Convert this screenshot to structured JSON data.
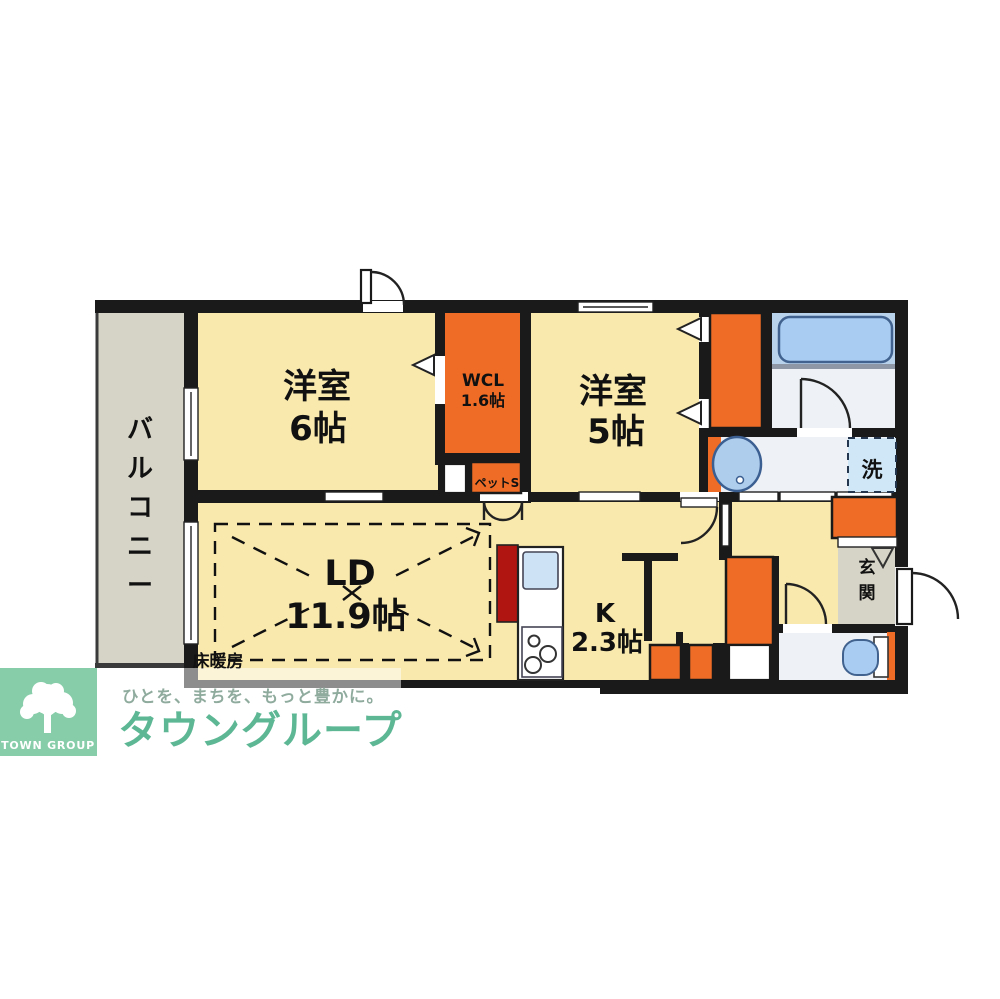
{
  "floorplan": {
    "rooms": {
      "balcony": {
        "label": "バルコニー"
      },
      "bedroom6": {
        "name": "洋室",
        "size": "6帖"
      },
      "wcl": {
        "name": "WCL",
        "size": "1.6帖"
      },
      "pet_storage": {
        "label": "ペットS"
      },
      "bedroom5": {
        "name": "洋室",
        "size": "5帖"
      },
      "living_dining": {
        "name": "LD",
        "size": "11.9帖",
        "floor_heating": "床暖房"
      },
      "kitchen": {
        "name": "K",
        "size": "2.3帖"
      },
      "laundry_space": {
        "label": "洗"
      },
      "entrance": {
        "label": "玄関"
      }
    }
  },
  "branding": {
    "tagline": "ひとを、まちを、もっと豊かに。",
    "company": "タウングループ",
    "logo": "TOWN GROUP"
  },
  "colors": {
    "wall": "#1a1a1a",
    "room_yellow": "#f9e9ad",
    "balcony_gray": "#d6d4c6",
    "closet_orange": "#ef6c26",
    "kitchen_counter_red": "#b11511",
    "bathtub_blue": "#a9cdf2",
    "bath_background_blue": "#b9d2ec",
    "wet_floor_gray": "#eef2f6",
    "laundry_blue": "#cfe7f6",
    "brand_green": "#5db795",
    "logo_green": "#87cda9"
  }
}
